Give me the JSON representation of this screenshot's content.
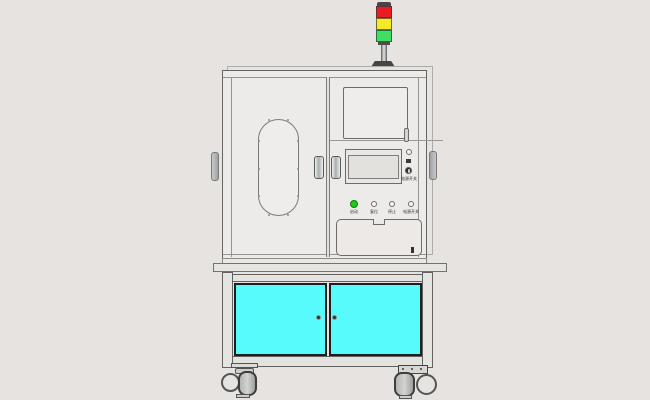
{
  "scene": {
    "background_color": "#e6e3e0",
    "body_color": "#edebe9",
    "outline_color": "#666461"
  },
  "tower_light": {
    "segments": [
      {
        "name": "red-lamp",
        "color": "#ec1c24"
      },
      {
        "name": "yellow-lamp",
        "color": "#f6e926"
      },
      {
        "name": "green-lamp",
        "color": "#3fdf64"
      }
    ]
  },
  "upper_cabinet": {
    "power_panel": {
      "power_switch_label": "电源开关"
    },
    "buttons": [
      {
        "label": "启动",
        "color": "#17cf17"
      },
      {
        "label": "复位",
        "color": "#f6f4f2"
      },
      {
        "label": "停止",
        "color": "#f6f4f2"
      },
      {
        "label": "电源开关",
        "color": "#f6f4f2"
      }
    ]
  },
  "lower_cart": {
    "door_color": "#58fbfb"
  }
}
